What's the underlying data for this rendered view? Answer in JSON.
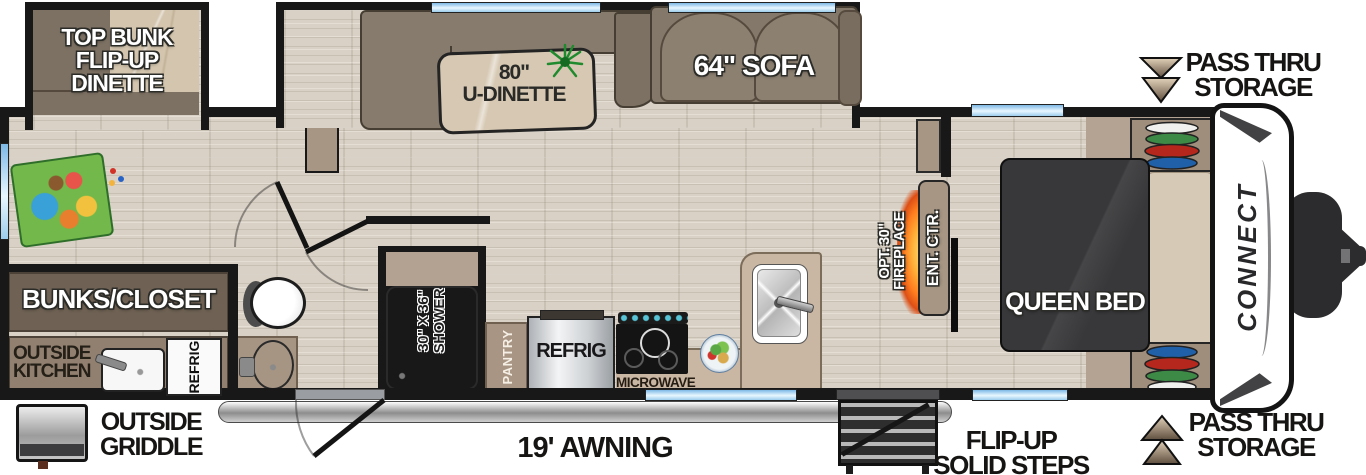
{
  "plan": {
    "bunk_dinette_label": "TOP BUNK\nFLIP-UP\nDINETTE",
    "u_dinette_label": "80\"\nU-DINETTE",
    "sofa_label": "64\" SOFA",
    "queen_bed_label": "QUEEN BED",
    "bunks_closet_label": "BUNKS/CLOSET",
    "outside_kitchen_label": "OUTSIDE\nKITCHEN",
    "outside_refrig_label": "REFRIG",
    "refrig_label": "REFRIG",
    "pantry_label": "PANTRY",
    "shower_label": "30\" X 36\"\nSHOWER",
    "microwave_label": "MICROWAVE",
    "ent_ctr_label": "ENT. CTR.",
    "fireplace_label": "OPT. 30\"\nFIREPLACE",
    "brand_label": "CONNECT"
  },
  "annotations": {
    "pass_thru_top_label": "PASS THRU\nSTORAGE",
    "pass_thru_bottom_label": "PASS THRU\nSTORAGE",
    "awning_label": "19' AWNING",
    "steps_label": "FLIP-UP\nSOLID STEPS",
    "griddle_label": "OUTSIDE\nGRIDDLE"
  },
  "colors": {
    "wall": "#181818",
    "floor": "#d9d1c5",
    "window_blue": "#7db9e6",
    "bed": "#38383a",
    "fireplace_glow": "#ff7d1f",
    "hanger_green": "#3c8a46",
    "hanger_red": "#b5271c",
    "hanger_blue": "#2060a8"
  }
}
